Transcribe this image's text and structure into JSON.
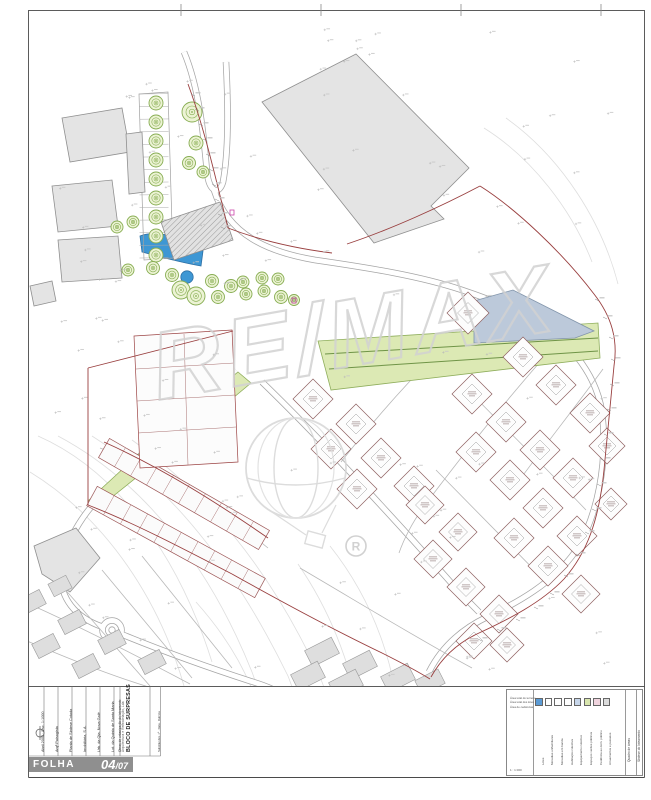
{
  "page": {
    "folha_label": "FOLHA",
    "sheet_main": "04",
    "sheet_suffix": "/07"
  },
  "titleblock": {
    "title": "BLOCO DE SURPRESAS",
    "subtitle": "Arquitectura e Remodelação, Lda",
    "fields": [
      {
        "x": 41,
        "s": 3.8,
        "t": "Abril 2002 · Esc. 1:1000"
      },
      {
        "x": 55,
        "s": 3.8,
        "t": "Arqª Paisagista"
      },
      {
        "x": 69,
        "s": 3.8,
        "t": "Planta de Síntese Cotada"
      },
      {
        "x": 83,
        "s": 3.8,
        "t": "Imobiliária, S.A."
      },
      {
        "x": 97,
        "s": 3.8,
        "t": "Urb. da Qta. Nova Galé"
      },
      {
        "x": 111,
        "s": 3.8,
        "t": "Lot. da Quinta de Santa Maria"
      },
      {
        "x": 119,
        "s": 3.2,
        "t": "Obras de urbanização do loteamento"
      },
      {
        "x": 158,
        "s": 2.8,
        "t": "Substitui des. nº · Data · Rubrica"
      }
    ]
  },
  "legend": {
    "left_top_lines": [
      "Área total do terreno",
      "Área total dos lotes",
      "Área de cedências"
    ],
    "left_bottom": "1 : 1 000",
    "right_cols": [
      "Quadro de áreas",
      "Síntese do loteamento"
    ],
    "items": [
      {
        "color": "#5b9bd5",
        "label": "Lotes"
      },
      {
        "color": "#ffffff",
        "label": "Moradias unifamiliares"
      },
      {
        "color": "#ffffff",
        "label": "Moradias em banda"
      },
      {
        "color": "#ffffff",
        "label": "Habitação colectiva"
      },
      {
        "color": "#c7d6ea",
        "label": "Equipamento colectivo"
      },
      {
        "color": "#d9e6ae",
        "label": "Espaços verdes públicos"
      },
      {
        "color": "#f0d4de",
        "label": "Cedência ao dom. público"
      },
      {
        "color": "#dcdcdc",
        "label": "Arruamentos e passeios"
      }
    ]
  },
  "plan": {
    "watermark": {
      "text": "RE/MAX",
      "reg": "R"
    },
    "colors": {
      "green_fill": "#dce9b4",
      "green_stroke": "#8fae5c",
      "green_line": "#6f9447",
      "pond_fill": "#3e97d4",
      "pond_stroke": "#2e6fa3",
      "bluelot_fill": "#bcc9da",
      "bluelot_stroke": "#8194aa",
      "building_fill": "#e4e4e4",
      "building_stroke": "#8f8f8f",
      "road_casing": "#a5a5a5",
      "red": "#993f3f",
      "magenta": "#cc44aa",
      "contour": "#dedede",
      "tree_stroke": "#87ad52",
      "tree_fill": "#ecf3d4",
      "lot_stroke": "#8d5f5f",
      "watermark_gray": "#d2d2d2"
    },
    "contours": [
      "M38,436 C120,472 180,560 212,662",
      "M30,472 C108,520 160,602 184,686",
      "M58,436 C148,484 212,572 252,672 C266,710 272,742 274,776",
      "M92,436 C180,492 242,582 288,676 C302,712 307,744 308,776",
      "M132,440 C222,504 282,592 322,682 C334,714 338,746 339,776",
      "M298,564 C338,622 360,690 366,762",
      "M330,546 C376,604 399,672 404,760",
      "M484,128 C532,158 572,210 592,262",
      "M506,118 C562,158 602,222 618,284",
      "M196,602 C230,640 252,680 262,720"
    ],
    "roads": [
      "M184,52 C200,90 204,140 207,172 C209,192 219,196 223,182 C229,150 228,100 226,62",
      "M214,190 C228,235 268,252 315,260 C370,268 420,276 462,290 C492,300 515,310 530,318",
      "M530,318 C565,336 596,372 602,412 C608,462 598,516 575,552 C553,583 517,603 487,617 C460,630 441,648 429,672",
      "M236,370 C186,412 136,458 101,496 C81,516 66,542 61,568 C58,598 76,618 103,627",
      "M121,634 C165,652 210,668 250,681 C260,684 266,686 272,689",
      "M262,382 C320,438 386,510 446,577 C459,592 469,602 479,612"
    ],
    "roundabout": [
      112,
      630
    ],
    "streets": [
      "M438,352 C405,385 370,425 341,462",
      "M540,362 C505,402 465,452 431,497 C416,516 406,533 399,553",
      "M603,369 C576,406 549,440 521,478",
      "M470,392 C505,428 546,468 586,510",
      "M436,470 C470,505 510,545 549,585",
      "M100,448 C160,470 216,506 268,548",
      "M88,500 C150,521 206,553 258,592",
      "M62,586 L150,686",
      "M102,570 L192,678",
      "M142,556 L232,668",
      "M20,600 C70,622 130,652 190,684",
      "M20,638 C62,656 106,674 152,688",
      "M300,568 C358,602 420,640 472,668"
    ],
    "green": [
      "M238,372 L251,383 L162,457 L97,509 L88,501 L152,442 Z",
      "M318,341 L598,323 L600,358 L331,390 Z"
    ],
    "green_lines": [
      "M325,354 L598,338",
      "M329,369 L598,351"
    ],
    "pond": "M140,236 C158,229 184,238 203,251 L201,266 C178,262 157,256 142,252 Z",
    "pool": [
      187,
      277,
      6.2
    ],
    "blue_lot": "M474,301 L513,290 L594,331 L575,338 L474,343 Z",
    "buildings": [
      {
        "d": "M262,102 L356,54 L469,168 L431,206 L444,219 L374,243 Z",
        "h": false
      },
      {
        "d": "M62,118 L122,108 L130,152 L70,162 Z",
        "h": false
      },
      {
        "d": "M52,186 L112,180 L118,226 L58,232 Z",
        "h": false
      },
      {
        "d": "M58,240 L118,236 L122,278 L62,282 Z",
        "h": false
      },
      {
        "d": "M126,134 L142,132 L145,192 L129,194 Z",
        "h": false
      },
      {
        "d": "M30,286 L52,281 L56,301 L34,306 Z",
        "h": false
      },
      {
        "d": "M34,546 L76,528 L100,558 L70,592 L42,574 Z",
        "h": false
      },
      {
        "d": "M220,202 L233,240 L174,260 L161,222 Z",
        "h": true
      }
    ],
    "gridhouses": [
      [
        32,
        602,
        24,
        16,
        -27
      ],
      [
        72,
        622,
        24,
        16,
        -27
      ],
      [
        112,
        642,
        24,
        16,
        -27
      ],
      [
        152,
        662,
        24,
        16,
        -27
      ],
      [
        46,
        646,
        24,
        16,
        -27
      ],
      [
        86,
        666,
        24,
        16,
        -27
      ],
      [
        60,
        586,
        20,
        14,
        -27
      ],
      [
        322,
        652,
        30,
        18,
        -27
      ],
      [
        360,
        665,
        30,
        18,
        -27
      ],
      [
        398,
        678,
        30,
        18,
        -27
      ],
      [
        308,
        676,
        30,
        18,
        -27
      ],
      [
        346,
        684,
        30,
        18,
        -27
      ],
      [
        430,
        682,
        26,
        16,
        -27
      ]
    ],
    "parking": {
      "outline": "M139,94 L168,92 L173,258 L144,260 Z",
      "y0": 94,
      "y1": 258,
      "n": 13,
      "xa": 139.5,
      "xb": 168.5
    },
    "trees": [
      [
        156,
        103,
        7
      ],
      [
        156,
        122,
        7
      ],
      [
        156,
        141,
        7
      ],
      [
        156,
        160,
        7
      ],
      [
        156,
        179,
        7
      ],
      [
        156,
        198,
        7
      ],
      [
        156,
        217,
        7
      ],
      [
        156,
        236,
        7
      ],
      [
        156,
        255,
        7
      ],
      [
        192,
        112,
        10
      ],
      [
        196,
        143,
        7
      ],
      [
        189,
        163,
        6.5
      ],
      [
        203,
        172,
        6
      ],
      [
        117,
        227,
        6
      ],
      [
        133,
        222,
        6
      ],
      [
        128,
        270,
        6
      ],
      [
        153,
        268,
        6.5
      ],
      [
        172,
        275,
        6.5
      ],
      [
        181,
        290,
        9
      ],
      [
        196,
        296,
        9
      ],
      [
        212,
        281,
        6.5
      ],
      [
        218,
        297,
        6.5
      ],
      [
        231,
        286,
        6.5
      ],
      [
        243,
        282,
        6
      ],
      [
        246,
        294,
        6
      ],
      [
        262,
        278,
        6
      ],
      [
        264,
        291,
        6
      ],
      [
        278,
        279,
        6
      ],
      [
        281,
        297,
        6.5
      ],
      [
        294,
        300,
        5.5
      ]
    ],
    "diamonds": [
      [
        313,
        399,
        20
      ],
      [
        356,
        424,
        20
      ],
      [
        331,
        449,
        20
      ],
      [
        381,
        458,
        20
      ],
      [
        414,
        486,
        20
      ],
      [
        357,
        489,
        20
      ],
      [
        468,
        313,
        21
      ],
      [
        523,
        357,
        20
      ],
      [
        556,
        385,
        20
      ],
      [
        590,
        413,
        20
      ],
      [
        472,
        394,
        20
      ],
      [
        506,
        422,
        20
      ],
      [
        540,
        450,
        20
      ],
      [
        573,
        478,
        20
      ],
      [
        607,
        446,
        18
      ],
      [
        476,
        452,
        20
      ],
      [
        510,
        480,
        20
      ],
      [
        543,
        508,
        20
      ],
      [
        577,
        536,
        20
      ],
      [
        514,
        538,
        20
      ],
      [
        548,
        566,
        20
      ],
      [
        581,
        594,
        19
      ],
      [
        611,
        504,
        16
      ],
      [
        425,
        505,
        19
      ],
      [
        458,
        532,
        19
      ],
      [
        433,
        559,
        19
      ],
      [
        466,
        587,
        19
      ],
      [
        499,
        614,
        19
      ],
      [
        474,
        641,
        18
      ],
      [
        507,
        645,
        17
      ]
    ],
    "bands": [
      {
        "a": [
          104,
          448
        ],
        "b": [
          264,
          540
        ],
        "w": 22,
        "n": 10
      },
      {
        "a": [
          92,
          496
        ],
        "b": [
          260,
          588
        ],
        "w": 22,
        "n": 10
      }
    ],
    "leftlots": {
      "outline": "M134,336 L232,330 L238,462 L140,468 Z",
      "lines": [
        "M136,369 L234,363",
        "M137,401 L235,395",
        "M138,433 L236,427",
        "M184,334 L188,465"
      ]
    },
    "red": [
      "M188,84 C205,130 216,180 228,228",
      "M228,228 C262,241 300,249 332,253",
      "M480,186 C515,208 562,252 594,294 C612,317 618,340 614,366 L604,470 C599,520 587,553 564,579 C541,603 509,619 479,633 C457,643 441,659 431,677",
      "M480,186 C442,206 392,229 347,244",
      "M88,368 L233,331",
      "M88,368 L88,505",
      "M88,505 C132,522 182,548 232,574",
      "M232,574 C282,602 332,629 382,653 C402,663 417,671 430,679",
      "M104,442 C162,468 216,502 268,538"
    ],
    "magenta": [
      [
        230,
        210
      ],
      [
        292,
        298
      ]
    ],
    "tickchains": [
      {
        "pts": [
          [
            597,
            300
          ],
          [
            605,
            318
          ],
          [
            611,
            338
          ],
          [
            613,
            360
          ],
          [
            612,
            385
          ],
          [
            609,
            410
          ],
          [
            606,
            435
          ],
          [
            603,
            460
          ],
          [
            599,
            485
          ],
          [
            594,
            510
          ],
          [
            587,
            533
          ],
          [
            578,
            555
          ],
          [
            566,
            576
          ],
          [
            552,
            594
          ],
          [
            536,
            608
          ],
          [
            518,
            620
          ],
          [
            499,
            630
          ],
          [
            480,
            640
          ]
        ]
      },
      {
        "pts": [
          [
            193,
            95
          ],
          [
            197,
            110
          ],
          [
            201,
            125
          ],
          [
            205,
            140
          ],
          [
            208,
            155
          ],
          [
            211,
            170
          ],
          [
            214,
            185
          ],
          [
            217,
            200
          ],
          [
            220,
            215
          ],
          [
            223,
            228
          ]
        ]
      }
    ],
    "frame": {
      "rules_x": [
        44,
        58,
        72,
        86,
        100,
        114,
        120,
        150,
        160.5
      ],
      "fold_ticks_x": [
        181,
        321,
        461,
        601
      ]
    }
  }
}
